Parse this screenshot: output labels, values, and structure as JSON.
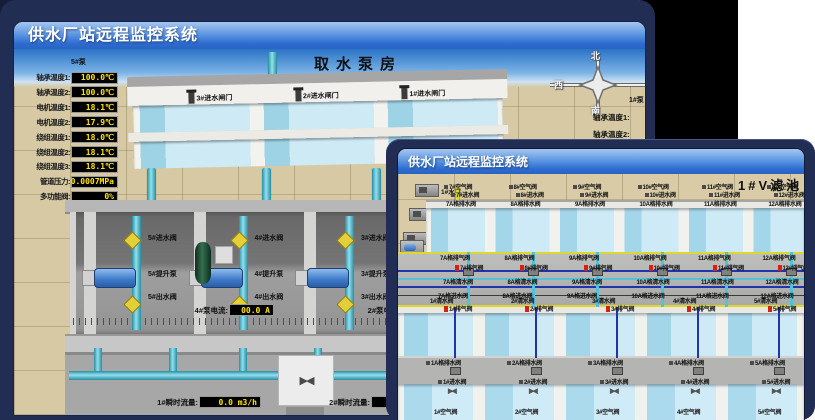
{
  "page": {
    "colors": {
      "backdrop_navy": "#212d52",
      "backdrop_black": "#000000",
      "page_white": "#ffffff",
      "titlebar_blue": "#2d6cd0",
      "led_text_yellow": "#ffe600",
      "pipe_cyan": "#55c3d8",
      "valve_yellow": "#e3cf38",
      "valve_red": "#d42310",
      "water_blue": "#a4d6ea",
      "ground_tan": "#d6c9a4"
    }
  },
  "back_window": {
    "title": "供水厂站远程监控系统",
    "scene_title": "取水泵房",
    "pump_panel": {
      "header": "5#泵",
      "rows": [
        {
          "label": "轴承温度1:",
          "value": "100.0℃"
        },
        {
          "label": "轴承温度2:",
          "value": "100.0℃"
        },
        {
          "label": "电机温度1:",
          "value": "18.1℃"
        },
        {
          "label": "电机温度2:",
          "value": "17.9℃"
        },
        {
          "label": "绕组温度1:",
          "value": "18.0℃"
        },
        {
          "label": "绕组温度2:",
          "value": "18.1℃"
        },
        {
          "label": "绕组温度3:",
          "value": "18.1℃"
        },
        {
          "label": "管道压力:",
          "value": "0.0007MPa"
        },
        {
          "label": "多功能阀:",
          "value": "0%"
        }
      ]
    },
    "gates": [
      {
        "label": "3#进水闸门"
      },
      {
        "label": "2#进水闸门"
      },
      {
        "label": "1#进水闸门"
      }
    ],
    "compass": {
      "north": "北",
      "west": "西",
      "south": "南"
    },
    "right_panel": {
      "header": "1#泵",
      "labels": [
        {
          "label": "轴承温度1:"
        },
        {
          "label": "轴承温度2:"
        }
      ]
    },
    "pump_bays": [
      {
        "inlet": "5#进水阀",
        "pump": "5#提升泵",
        "outlet": "5#出水阀"
      },
      {
        "inlet": "4#进水阀",
        "pump": "4#提升泵",
        "outlet": "4#出水阀"
      },
      {
        "inlet": "3#进水阀",
        "pump": "3#提升泵",
        "outlet": "3#出水阀"
      }
    ],
    "current_readouts": [
      {
        "label": "4#泵电流:",
        "value": "00.0 A"
      },
      {
        "label": "2#泵电流:",
        "value": "00.0 A"
      }
    ],
    "flow_readouts": [
      {
        "label": "1#瞬时流量:",
        "value": "0.0 m3/h"
      },
      {
        "label": "2#瞬时流量:",
        "value": "0.0 m3/h"
      }
    ]
  },
  "front_window": {
    "title": "供水厂站远程监控系统",
    "scene_title": "1#V滤池",
    "pumps": [
      {
        "label": "1#水泵"
      },
      {
        "label": "2#水泵"
      },
      {
        "label": "3#水泵"
      }
    ],
    "blowers": [
      {
        "label": "1#风机"
      },
      {
        "label": "2#风机"
      },
      {
        "label": "3#风机"
      }
    ],
    "top_filters": [
      {
        "air": "7#空气阀",
        "inlet": "7#进水阀",
        "drain_a": "7A格排水阀",
        "exhaust_a": "7A格排气阀",
        "exhaust": "7#排气阀",
        "clean_a": "7A格清水阀",
        "inlet_a": "7A格进水阀"
      },
      {
        "air": "8#空气阀",
        "inlet": "8#进水阀",
        "drain_a": "8A格排水阀",
        "exhaust_a": "8A格排气阀",
        "exhaust": "8#排气阀",
        "clean_a": "8A格清水阀",
        "inlet_a": "8A格进水阀"
      },
      {
        "air": "9#空气阀",
        "inlet": "9#进水阀",
        "drain_a": "9A格排水阀",
        "exhaust_a": "9A格排气阀",
        "exhaust": "9#排气阀",
        "clean_a": "9A格清水阀",
        "inlet_a": "9A格进水阀"
      },
      {
        "air": "10#空气阀",
        "inlet": "10#进水阀",
        "drain_a": "10A格排水阀",
        "exhaust_a": "10A格排气阀",
        "exhaust": "10#排气阀",
        "clean_a": "10A格清水阀",
        "inlet_a": "10A格进水阀"
      },
      {
        "air": "11#空气阀",
        "inlet": "11#进水阀",
        "drain_a": "11A格排水阀",
        "exhaust_a": "11A格排气阀",
        "exhaust": "11#排气阀",
        "clean_a": "11A格清水阀",
        "inlet_a": "11A格进水阀"
      },
      {
        "air": "12#空气阀",
        "inlet": "12#进水阀",
        "drain_a": "12A格排水阀",
        "exhaust_a": "12A格排气阀",
        "exhaust": "12#排气阀",
        "clean_a": "12A格清水阀",
        "inlet_a": "12A格进水阀"
      }
    ],
    "bottom_filters": [
      {
        "clean": "1#清水阀",
        "exhaust": "1#排气阀",
        "drain_a": "1A格排水阀",
        "inlet": "1#进水阀",
        "air": "1#空气阀"
      },
      {
        "clean": "2#清水阀",
        "exhaust": "2#排气阀",
        "drain_a": "2A格排水阀",
        "inlet": "2#进水阀",
        "air": "2#空气阀"
      },
      {
        "clean": "3#清水阀",
        "exhaust": "3#排气阀",
        "drain_a": "3A格排水阀",
        "inlet": "3#进水阀",
        "air": "3#空气阀"
      },
      {
        "clean": "4#清水阀",
        "exhaust": "4#排气阀",
        "drain_a": "4A格排水阀",
        "inlet": "4#进水阀",
        "air": "4#空气阀"
      },
      {
        "clean": "5#清水阀",
        "exhaust": "5#排气阀",
        "drain_a": "5A格排水阀",
        "inlet": "5#进水阀",
        "air": "5#空气阀"
      },
      {
        "clean": "6#清水阀",
        "exhaust": "6#排气阀",
        "drain_a": "6A格排水阀",
        "inlet": "6#进水阀",
        "air": "6#空气阀"
      }
    ]
  }
}
